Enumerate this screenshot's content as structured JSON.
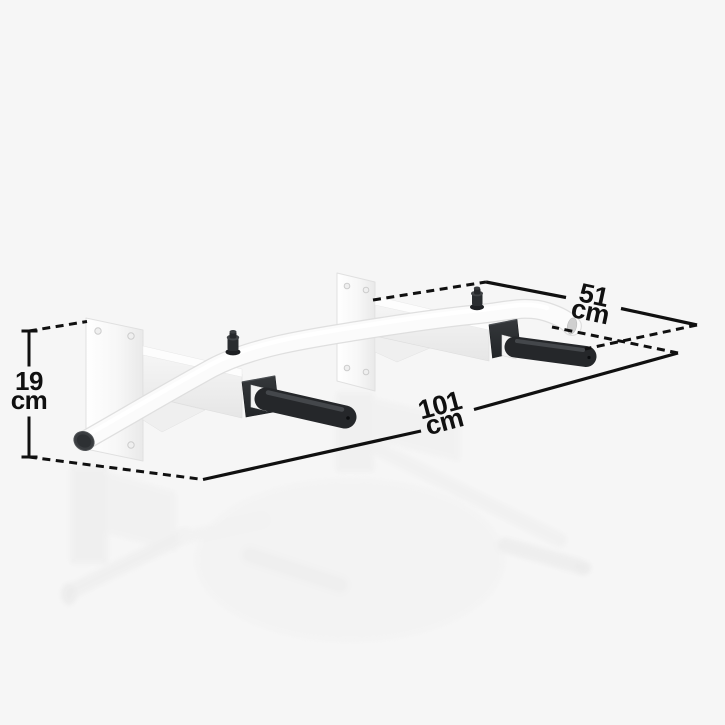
{
  "illustration": {
    "subject": "wall-mounted pull-up bar",
    "view": "dimension-annotated product render"
  },
  "dimensions": {
    "height": {
      "value": "19",
      "unit": "cm"
    },
    "depth": {
      "value": "51",
      "unit": "cm"
    },
    "width": {
      "value": "101",
      "unit": "cm"
    }
  },
  "colors": {
    "background": "#f6f6f6",
    "annotation": "#101010",
    "product-body": "#fafafa",
    "product-edge": "#dedede",
    "grip": "#25272a",
    "flange": "#2c2f32"
  }
}
